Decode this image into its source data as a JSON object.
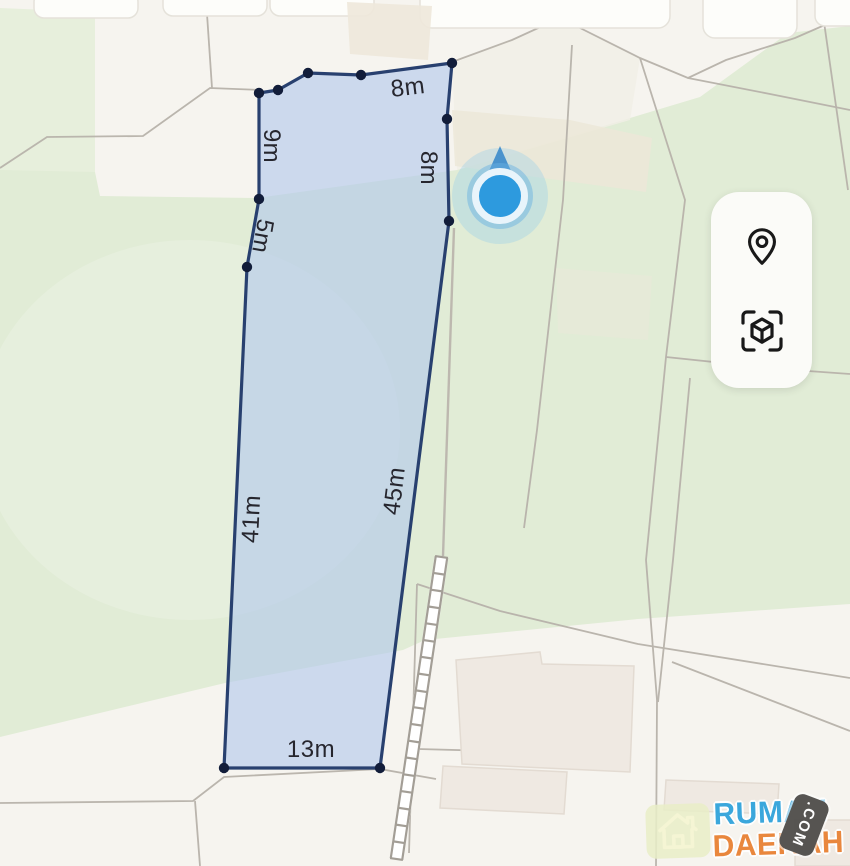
{
  "map": {
    "measurement_unit": "m",
    "plot": {
      "stroke_color": "#28406f",
      "fill_color": "rgba(178,200,235,0.62)",
      "vertex_color": "#121d3a",
      "vertices": [
        [
          259,
          93
        ],
        [
          278,
          90
        ],
        [
          308,
          73
        ],
        [
          361,
          75
        ],
        [
          452,
          63
        ],
        [
          447,
          119
        ],
        [
          449,
          221
        ],
        [
          380,
          768
        ],
        [
          224,
          768
        ],
        [
          247,
          267
        ],
        [
          259,
          199
        ]
      ],
      "measurements": [
        {
          "label": "8m",
          "x": 408,
          "y": 88,
          "rot": -7
        },
        {
          "label": "8m",
          "x": 428,
          "y": 168,
          "rot": 90
        },
        {
          "label": "9m",
          "x": 271,
          "y": 146,
          "rot": 90
        },
        {
          "label": "5m",
          "x": 262,
          "y": 236,
          "rot": 100
        },
        {
          "label": "41m",
          "x": 252,
          "y": 519,
          "rot": -87
        },
        {
          "label": "45m",
          "x": 395,
          "y": 491,
          "rot": -83
        },
        {
          "label": "13m",
          "x": 311,
          "y": 750,
          "rot": 0
        }
      ]
    },
    "user_location": {
      "x": 500,
      "y": 196,
      "core_color": "#2d9ade",
      "ring_color": "#e8f4fb",
      "cone_color": "#3f8ccb"
    }
  },
  "controls": {
    "buttons": [
      {
        "icon": "map-pin-icon"
      },
      {
        "icon": "ar-cube-icon"
      }
    ]
  },
  "watermark": {
    "brand_top": "RUMAH",
    "brand_bottom": "DAERAH",
    "badge": ".COM",
    "brand_top_color": "#35a5dc",
    "brand_bottom_color": "#e98438",
    "badge_bg": "#52504d"
  }
}
